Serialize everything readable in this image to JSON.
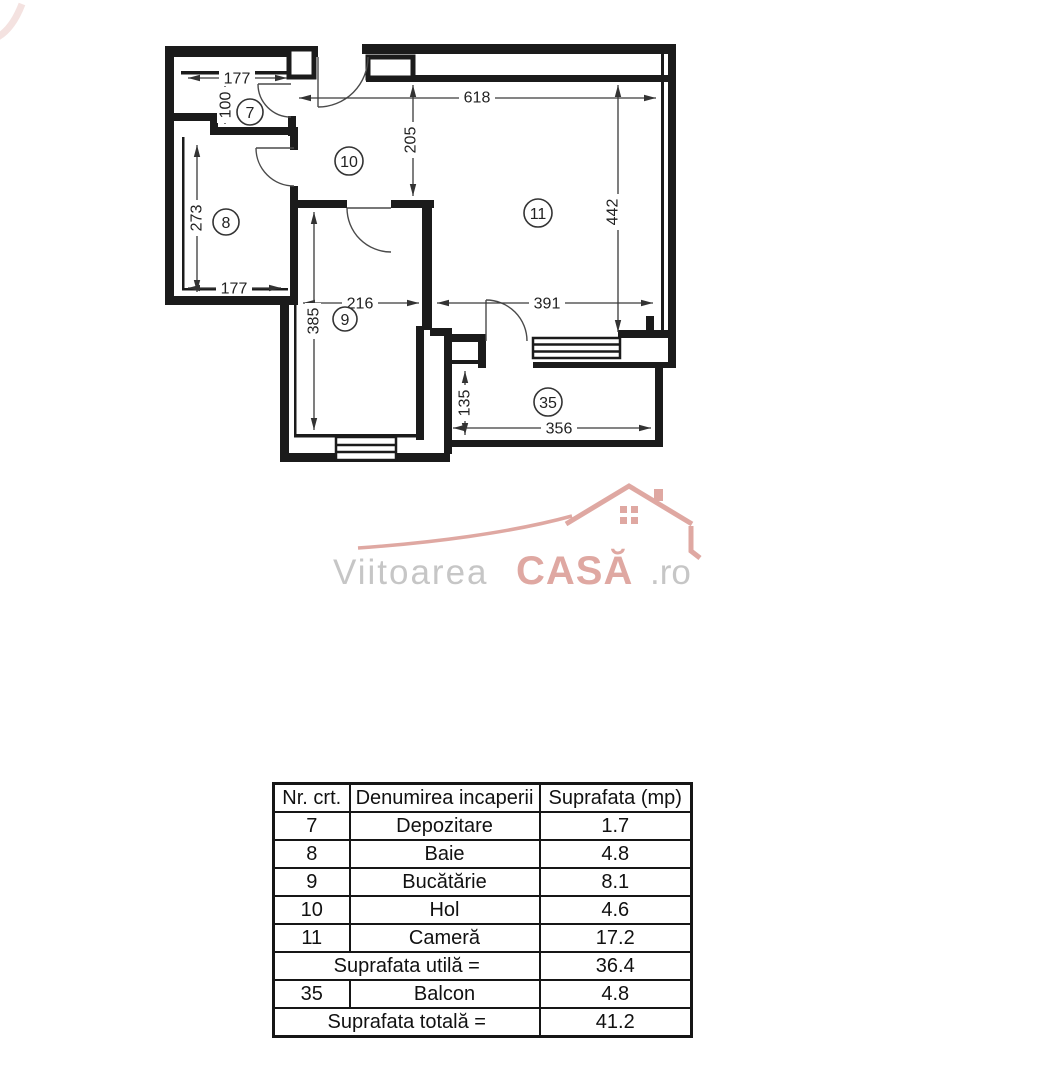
{
  "plan": {
    "room_labels": {
      "r7": "7",
      "r8": "8",
      "r9": "9",
      "r10": "10",
      "r11": "11",
      "r35": "35"
    },
    "dims": {
      "w177_top": "177",
      "h100": "100",
      "h273": "273",
      "w177_bottom": "177",
      "w618": "618",
      "h205": "205",
      "h442": "442",
      "w216": "216",
      "w391": "391",
      "h385": "385",
      "h135": "135",
      "w356": "356"
    },
    "wall_color": "#1b1b1b"
  },
  "logo": {
    "name_primary": "Viitoarea",
    "name_accent": "CASĂ",
    "name_suffix": ".ro",
    "accent_color": "#dfa8a2",
    "gray_color": "#c6c6c6"
  },
  "table": {
    "headers": [
      "Nr. crt.",
      "Denumirea incaperii",
      "Suprafata (mp)"
    ],
    "rows": [
      {
        "nr": "7",
        "name": "Depozitare",
        "area": "1.7"
      },
      {
        "nr": "8",
        "name": "Baie",
        "area": "4.8"
      },
      {
        "nr": "9",
        "name": "Bucătărie",
        "area": "8.1"
      },
      {
        "nr": "10",
        "name": "Hol",
        "area": "4.6"
      },
      {
        "nr": "11",
        "name": "Cameră",
        "area": "17.2"
      }
    ],
    "subtotal": {
      "label": "Suprafata utilă =",
      "value": "36.4"
    },
    "balcony": {
      "nr": "35",
      "name": "Balcon",
      "area": "4.8"
    },
    "total": {
      "label": "Suprafata totală =",
      "value": "41.2"
    }
  }
}
